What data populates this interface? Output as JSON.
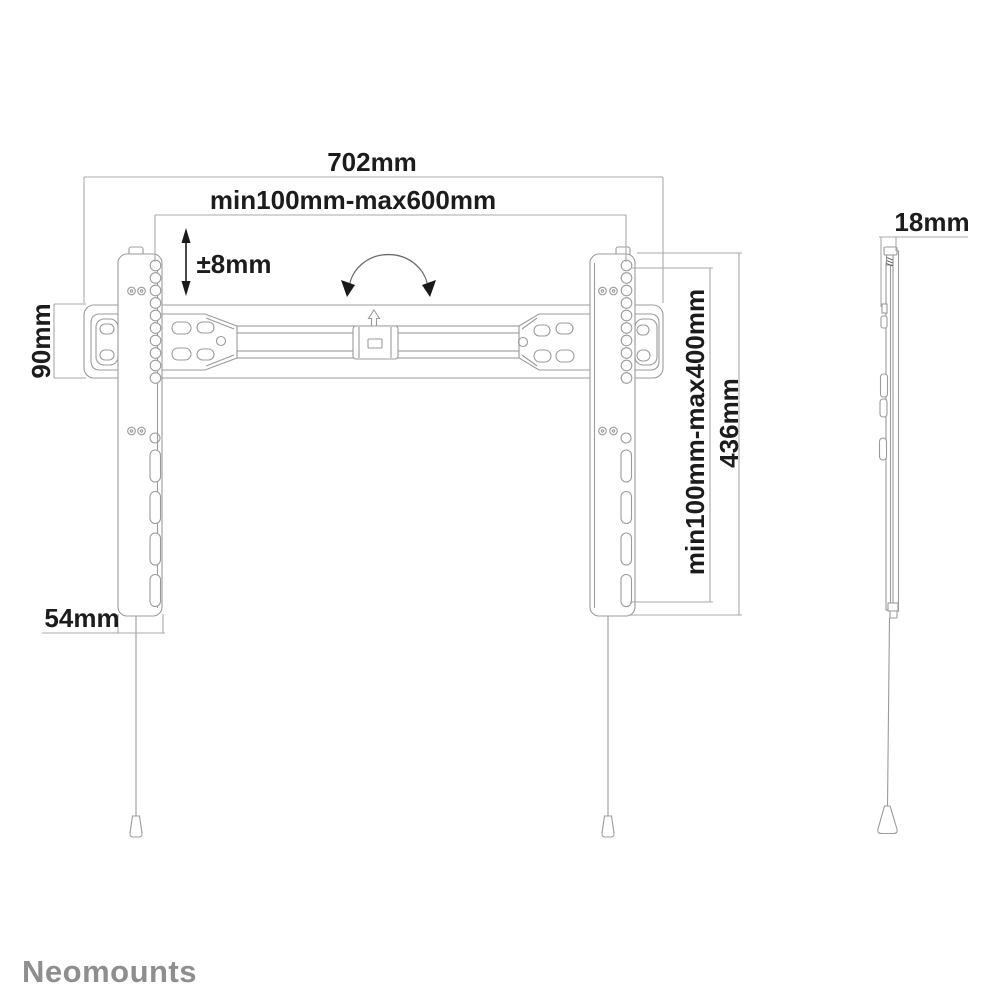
{
  "brand": {
    "logo_text": "Neomounts",
    "logo_color": "#8e8e8e"
  },
  "dimensions": {
    "total_width": "702mm",
    "horizontal_vesa_range": "min100mm-max600mm",
    "height_adjustment": "±8mm",
    "plate_height": "90mm",
    "rail_width": "54mm",
    "vertical_vesa_range": "min100mm-max400mm",
    "rail_height": "436mm",
    "depth": "18mm"
  },
  "colors": {
    "background": "#ffffff",
    "drawing_line": "#9b9b9b",
    "dimension_line": "#aaaaaa",
    "dimension_text": "#1c1c1c",
    "arrow_fill": "#1a1a1a",
    "logo": "#8e8e8e"
  }
}
